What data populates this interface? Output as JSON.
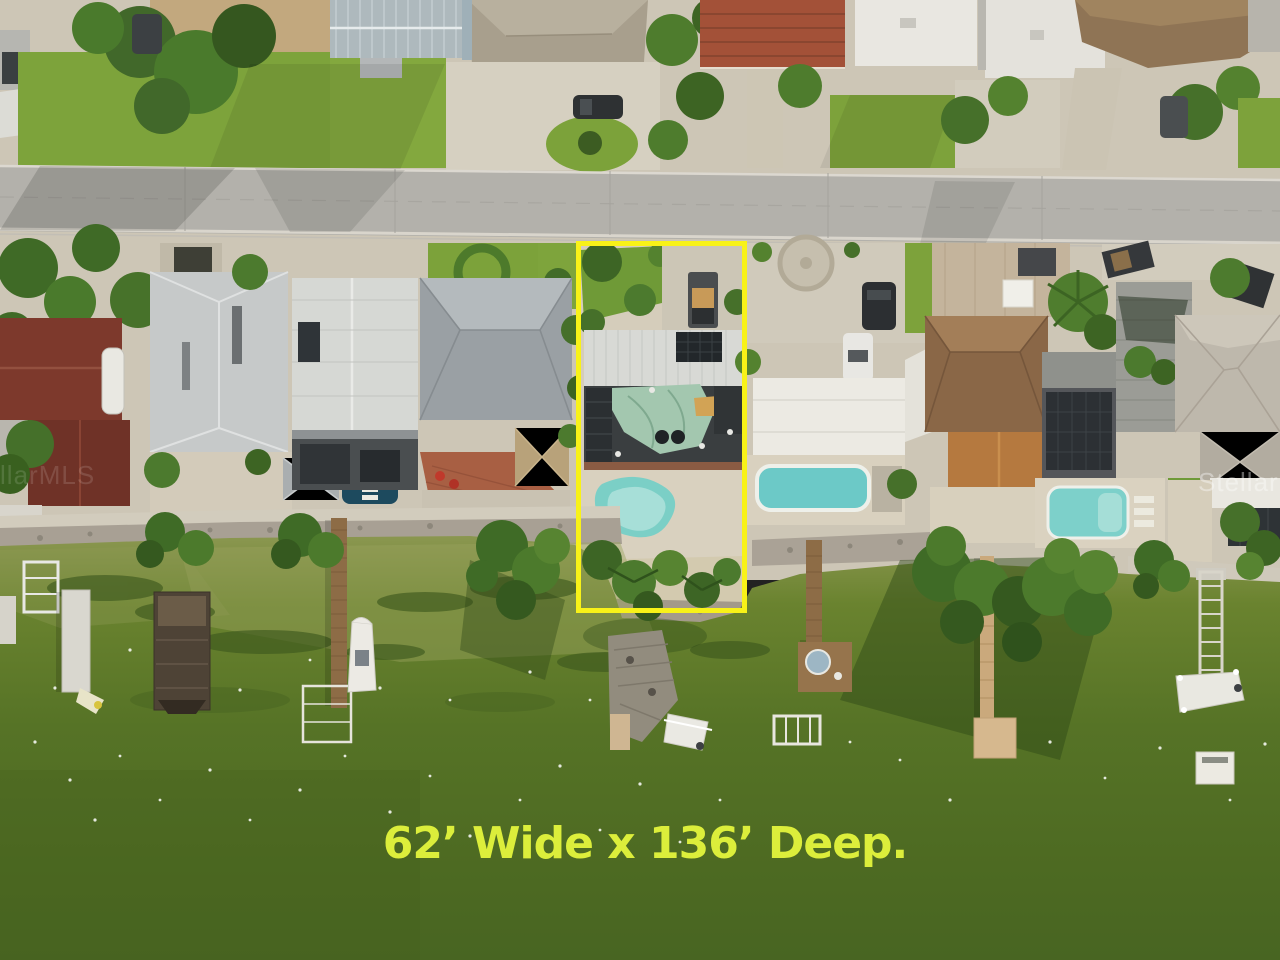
{
  "image_type": "aerial-real-estate-photo",
  "scene_description": "Aerial drone view of a waterfront residential street; one lot is outlined in yellow with its dimensions written over the green bay water below",
  "annotations": {
    "lot_dimensions_text": "62’ Wide x 136’ Deep.",
    "text_color": "#dcee3b",
    "lot_outline_color": "#f8f218"
  },
  "watermarks": {
    "right": "StellarMLS",
    "left": "StellarMLS"
  },
  "palette": {
    "water": "#56742a",
    "road": "#b3b1ab",
    "grass": "#7da23b",
    "pool": "#74cbc4",
    "roof_tarp": "#a3c7af"
  }
}
